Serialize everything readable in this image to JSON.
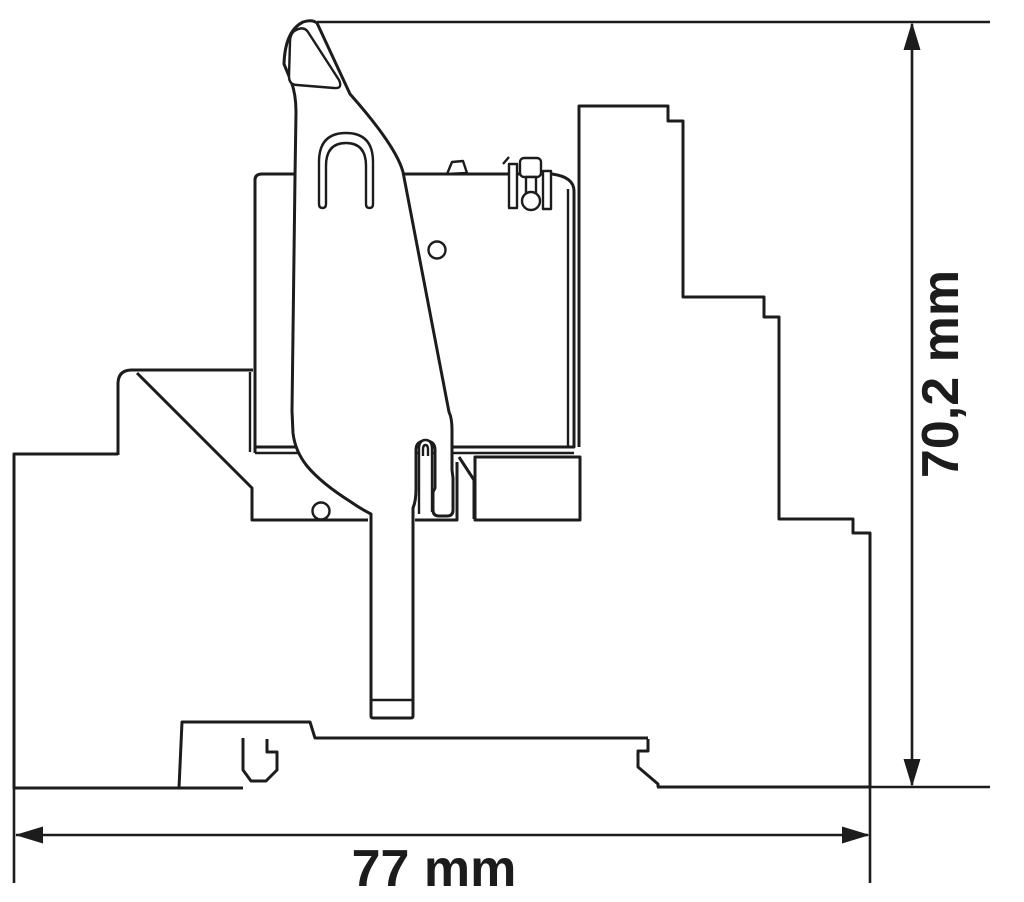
{
  "drawing": {
    "type": "technical-dimension-drawing",
    "subject": "Relay module with socket and release lever on DIN rail, side view",
    "view": "side profile cross-section",
    "dimensions": {
      "width_label": "77 mm",
      "height_label": "70,2 mm"
    },
    "colors": {
      "line": "#1c1c1c",
      "background": "#ffffff"
    }
  }
}
